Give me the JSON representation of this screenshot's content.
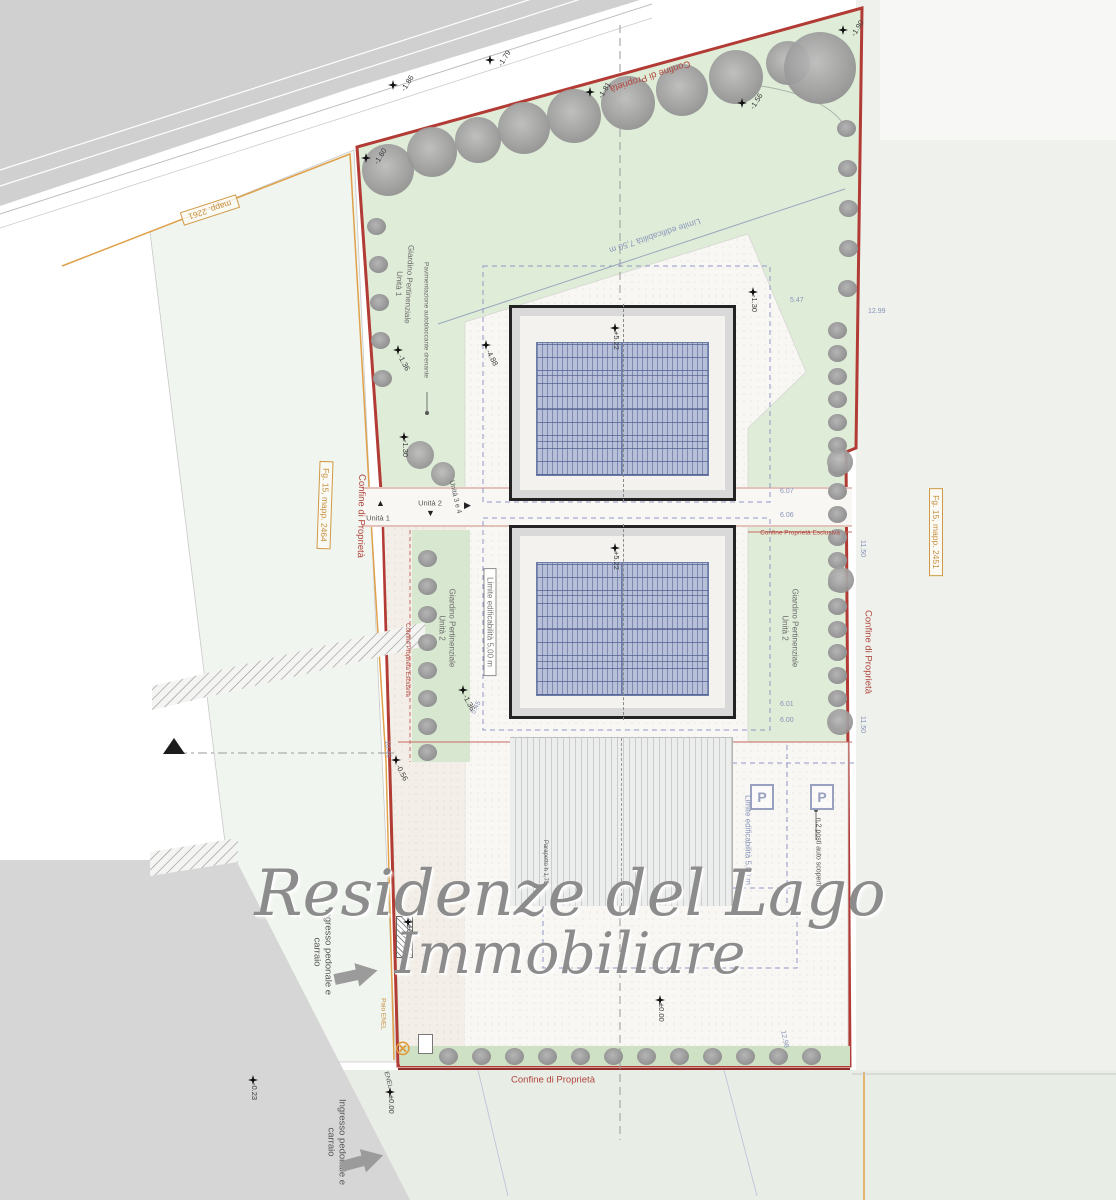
{
  "watermark": {
    "line1": "Residenze del Lago",
    "line2": "Immobiliare"
  },
  "boundaries": {
    "confine_proprieta": "Confine di Proprietà",
    "confine_esclusiva": "Confine Proprietà Esclusiva",
    "limite_5": "Limite edificabilità 5,00 m",
    "limite_75": "Limite edificabilità 7,50 m"
  },
  "cadastral": {
    "mapp_top": "mapp. 2261",
    "fg_left": "Fg. 15, mapp. 2464",
    "fg_right": "Fg. 15, mapp. 2451"
  },
  "areas": {
    "giardino": "Giardino Pertinenziale",
    "unita1": "Unità 1",
    "unita2": "Unità 2",
    "unita34": "Unità 3 e 4",
    "pavimentazione": "Pavimentazione autobloccante drenante",
    "posti_auto": "n.2 posti auto scoperti",
    "parapetto": "Parapetto h 1,75",
    "parking_symbol": "P"
  },
  "entrances": {
    "ingresso": "Ingresso pedonale e carraio",
    "palo_enel": "Palo ENEL",
    "enel": "ENEL",
    "enel_symbol": "⊗"
  },
  "elevations": {
    "e1": "-1.86",
    "e2": "-1.79",
    "e3": "-1.81",
    "e4": "-1.56",
    "e5": "-1.90",
    "e6": "-1.60",
    "e7": "-1.36",
    "e8": "-1.30",
    "e9": "+5.22",
    "e10": "-4.88",
    "e11": "-1.30",
    "e12": "+5.22",
    "e13": "-1.36",
    "e14": "-0.56",
    "e15": "±0.00",
    "e16": "±0.00",
    "e17": "-0.23",
    "e18": "±0.00"
  },
  "dimensions": {
    "d1": "5.47",
    "d2": "12.99",
    "d3": "6.07",
    "d4": "6.06",
    "d5": "11.50",
    "d6": "6.01",
    "d7": "6.00",
    "d8": "11.50",
    "d9": "5.45",
    "d10": "10.46",
    "d11": "12.98"
  },
  "colors": {
    "boundary": "#b23b35",
    "cadastral": "#cf9a45",
    "garden": "#dfecd8",
    "panel": "#b7c0d8",
    "watermark": "#8c8c8c"
  }
}
